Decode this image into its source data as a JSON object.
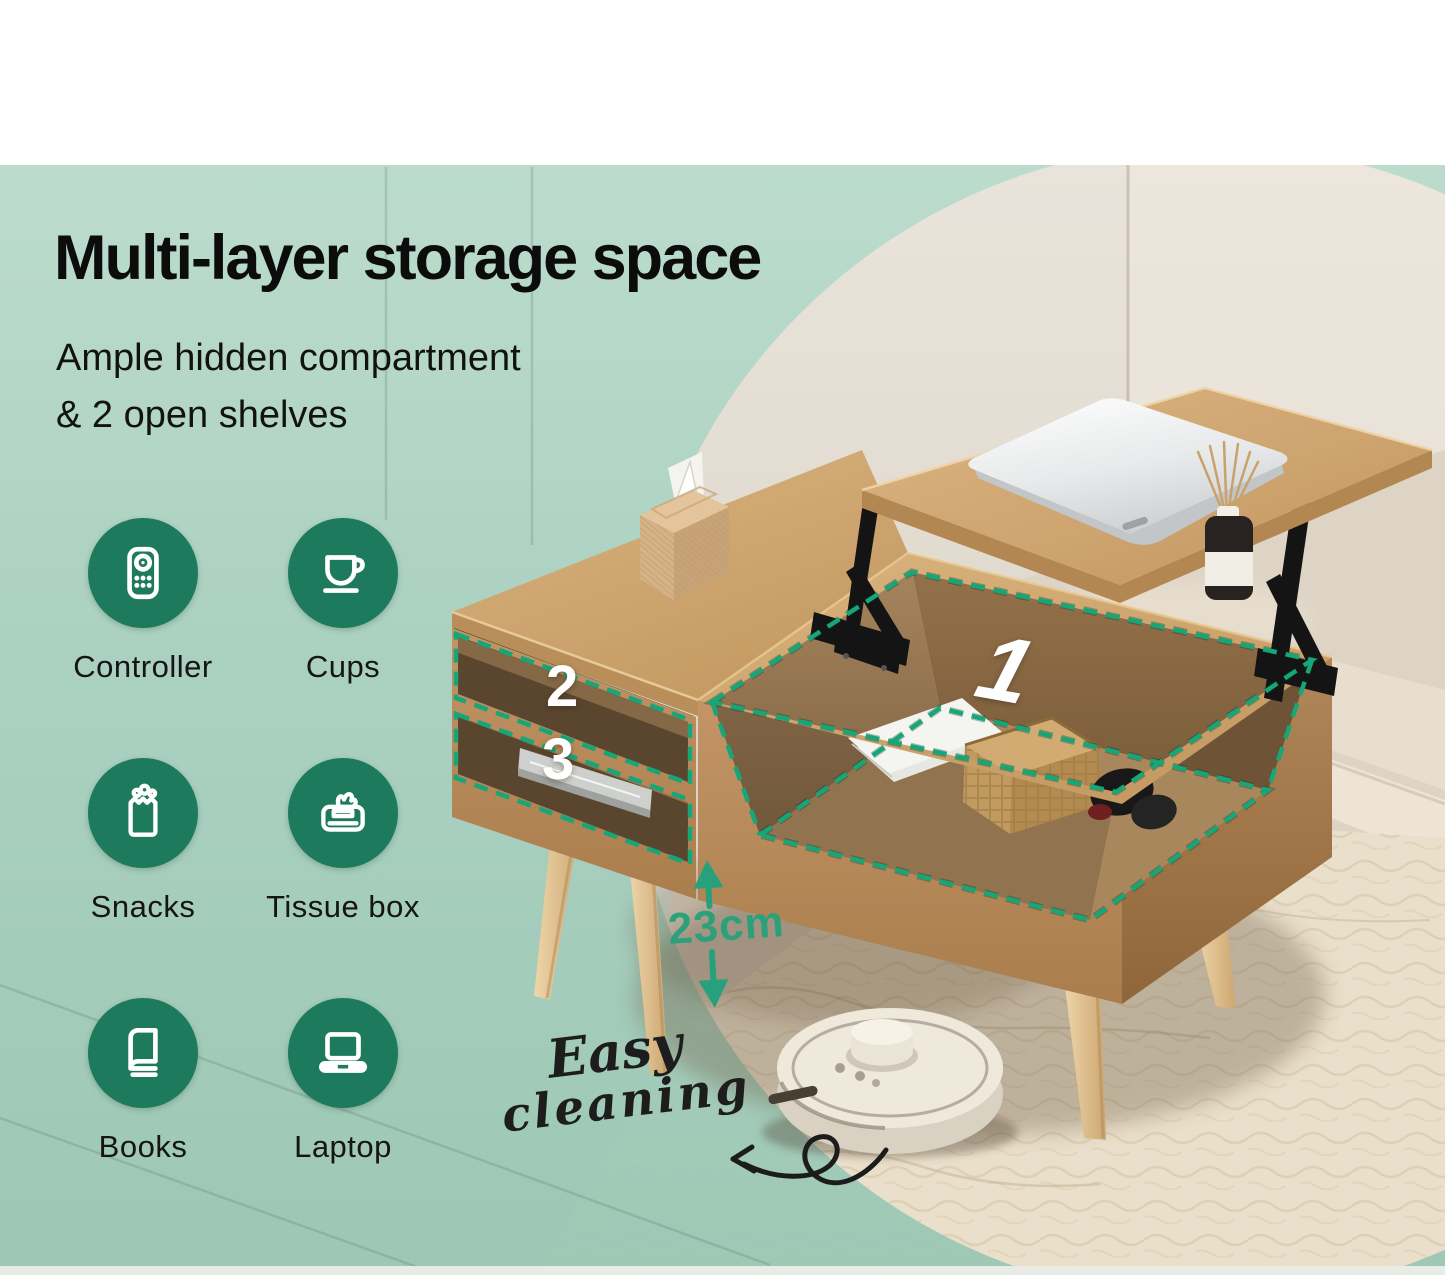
{
  "headline": {
    "title": "Multi-layer storage space",
    "subtitle_line1": "Ample hidden compartment",
    "subtitle_line2": "& 2 open shelves"
  },
  "features": [
    {
      "icon": "remote-control-icon",
      "label": "Controller"
    },
    {
      "icon": "coffee-cup-icon",
      "label": "Cups"
    },
    {
      "icon": "snack-bag-icon",
      "label": "Snacks"
    },
    {
      "icon": "tissue-box-icon",
      "label": "Tissue box"
    },
    {
      "icon": "book-icon",
      "label": "Books"
    },
    {
      "icon": "laptop-icon",
      "label": "Laptop"
    }
  ],
  "callouts": {
    "hidden_compartment": "1",
    "open_shelf_top": "2",
    "open_shelf_bottom": "3"
  },
  "measurement": {
    "clearance": "23cm"
  },
  "script_note": {
    "line1": "Easy",
    "line2": "cleaning"
  },
  "colors": {
    "teal_overlay": "#a8d0c0",
    "icon_circle": "#1e7a5c",
    "dashed_outline": "#16a678",
    "measurement_text": "#26a17b",
    "wood": "#c9a36c",
    "headline_text": "#0c0c0c"
  }
}
